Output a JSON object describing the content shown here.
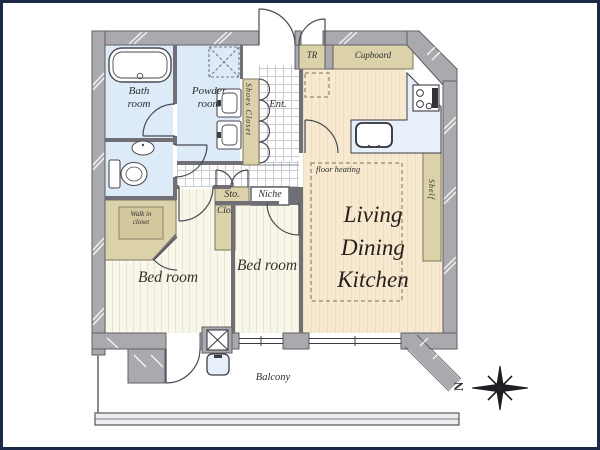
{
  "floorplan": {
    "labels": {
      "bath_room": "Bath\nroom",
      "powder_room": "Powder\nroom",
      "shoes_closet": "Shoes Closet",
      "entrance": "Ent.",
      "trunk_room": "TR",
      "cupboard": "Cupboard",
      "shelf": "Shelf",
      "floor_heating": "floor heating",
      "ldk": "Living\nDining\nKitchen",
      "storage": "Sto.",
      "niche": "Niche",
      "closet": "Clo.",
      "walk_in_closet": "Walk in\ncloset",
      "bedroom_left": "Bed room",
      "bedroom_center": "Bed room",
      "balcony": "Balcony",
      "compass_north": "N"
    },
    "colors": {
      "frame_navy": "#1b2947",
      "wall_gray": "#a9a9ae",
      "wall_edge": "#5f5f66",
      "interior_wall": "#6f6f75",
      "water_room_blue": "#ddeaf7",
      "kitchen_counter_blue": "#e7f0fa",
      "ldk_floor_cream": "#f7e8d0",
      "ldk_stripe": "#eedcbe",
      "bedroom_floor": "#f9f7ea",
      "storage_beige": "#dbd2aa",
      "label_text": "#2f2f33"
    }
  }
}
